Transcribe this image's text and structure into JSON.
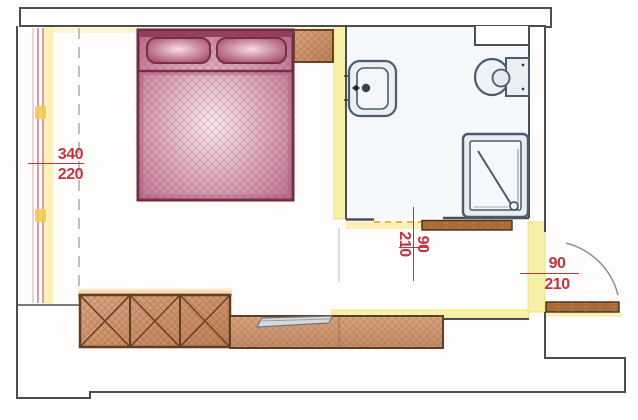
{
  "plan_type": "bedroom-with-ensuite-floor-plan",
  "dimensions": {
    "window_wall": {
      "num": "340",
      "den": "220"
    },
    "bathroom_door": {
      "num": "90",
      "den": "210"
    },
    "entrance_door": {
      "num": "90",
      "den": "210"
    }
  },
  "colors": {
    "dimension_red": "#bf3340",
    "wall_outline": "#4a4f55",
    "fixture_outline": "#4c5b6b",
    "bed_magenta": "#9c3e5e",
    "wood_brown": "#c98a64",
    "highlight_yellow": "#f7f0a8",
    "glow_orange": "#f0a843"
  }
}
